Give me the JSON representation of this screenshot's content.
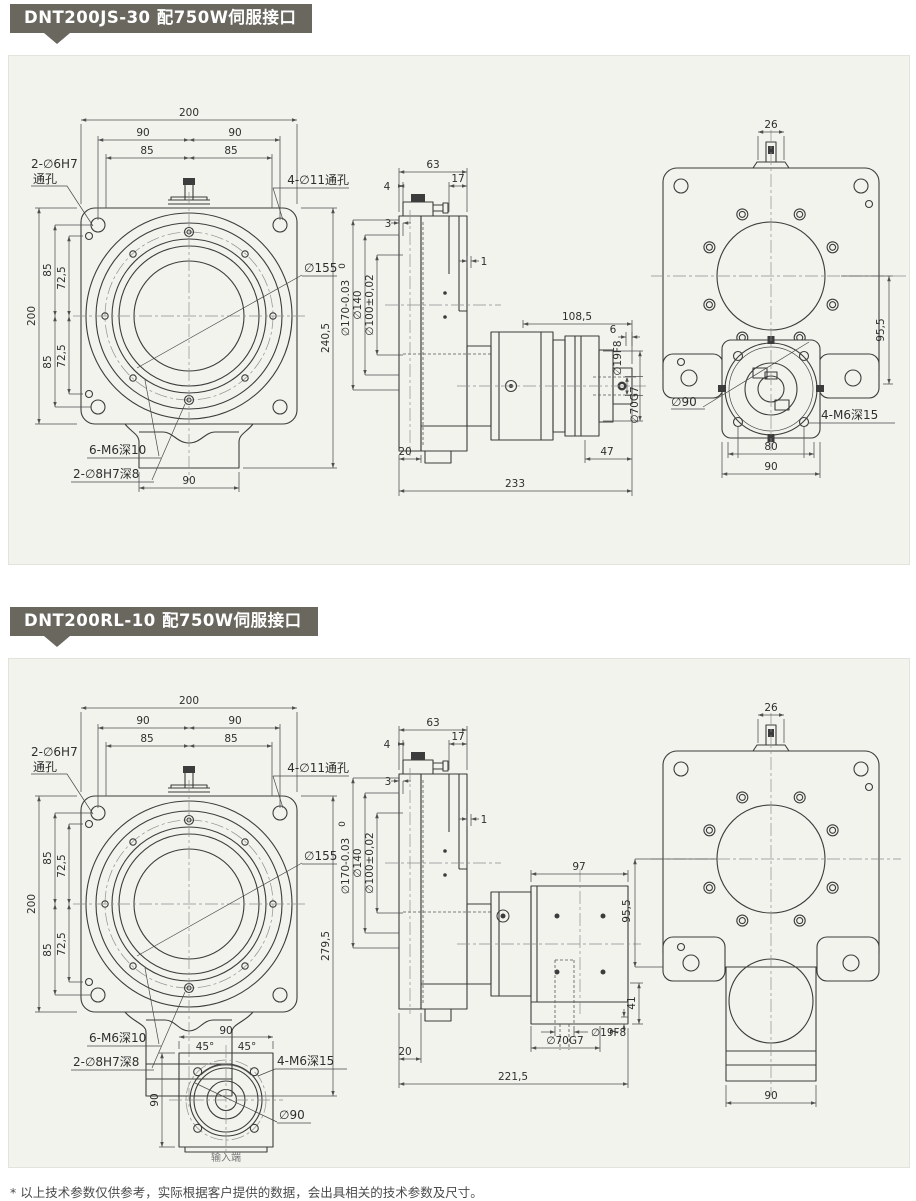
{
  "page": {
    "footer": "* 以上技术参数仅供参考，实际根据客户提供的数据，会出具相关的技术参数及尺寸。"
  },
  "colors": {
    "badge": "#6a675f",
    "panel": "#f2f3ed"
  },
  "s1": {
    "title": "DNT200JS-30 配750W伺服接口",
    "front": {
      "top_total": "200",
      "top_90l": "90",
      "top_90r": "90",
      "top_85l": "85",
      "top_85r": "85",
      "pin_label1": "2-∅6H7",
      "pin_label2": "通孔",
      "hole_label": "4-∅11通孔",
      "bc_label": "∅155",
      "left_200": "200",
      "left_85a": "85",
      "left_725a": "72,5",
      "left_85b": "85",
      "left_725b": "72,5",
      "right_height": "240,5",
      "m6_label": "6-M6深10",
      "dowel_label": "2-∅8H7深8",
      "bottom_90": "90"
    },
    "side": {
      "top_63": "63",
      "top_4": "4",
      "top_17": "17",
      "off_3": "3",
      "off_1": "1",
      "tol_0": "0",
      "dia_170": "∅170-0.03",
      "dia_140": "∅140",
      "dia_100": "∅100±0,02",
      "len_1085": "108,5",
      "len_6": "6",
      "dia_19": "∅19F8",
      "dia_70": "∅70G7",
      "bot_20": "20",
      "bot_47": "47",
      "bot_233": "233"
    },
    "rear": {
      "top_26": "26",
      "right_955": "95,5",
      "dia_90": "∅90",
      "m6_label": "4-M6深15",
      "bot_80": "80",
      "bot_90": "90"
    }
  },
  "s2": {
    "title": "DNT200RL-10 配750W伺服接口",
    "front": {
      "top_total": "200",
      "top_90l": "90",
      "top_90r": "90",
      "top_85l": "85",
      "top_85r": "85",
      "pin_label1": "2-∅6H7",
      "pin_label2": "通孔",
      "hole_label": "4-∅11通孔",
      "bc_label": "∅155",
      "left_200": "200",
      "left_85a": "85",
      "left_725a": "72,5",
      "left_85b": "85",
      "left_725b": "72,5",
      "right_height": "279,5",
      "m6_label": "6-M6深10",
      "dowel_label": "2-∅8H7深8"
    },
    "input": {
      "top_90": "90",
      "a45l": "45°",
      "a45r": "45°",
      "m6_label": "4-M6深15",
      "left_90": "90",
      "dia_90": "∅90",
      "caption": "输入端"
    },
    "side": {
      "top_63": "63",
      "top_4": "4",
      "top_17": "17",
      "off_3": "3",
      "off_1": "1",
      "tol_0": "0",
      "dia_170": "∅170-0.03",
      "dia_140": "∅140",
      "dia_100": "∅100±0,02",
      "len_97": "97",
      "len_41": "41",
      "len_7": "7",
      "dia_19": "∅19F8",
      "dia_70": "∅70G7",
      "bot_20": "20",
      "bot_2215": "221,5"
    },
    "rear": {
      "top_26": "26",
      "left_955": "95,5",
      "bot_90": "90"
    }
  }
}
